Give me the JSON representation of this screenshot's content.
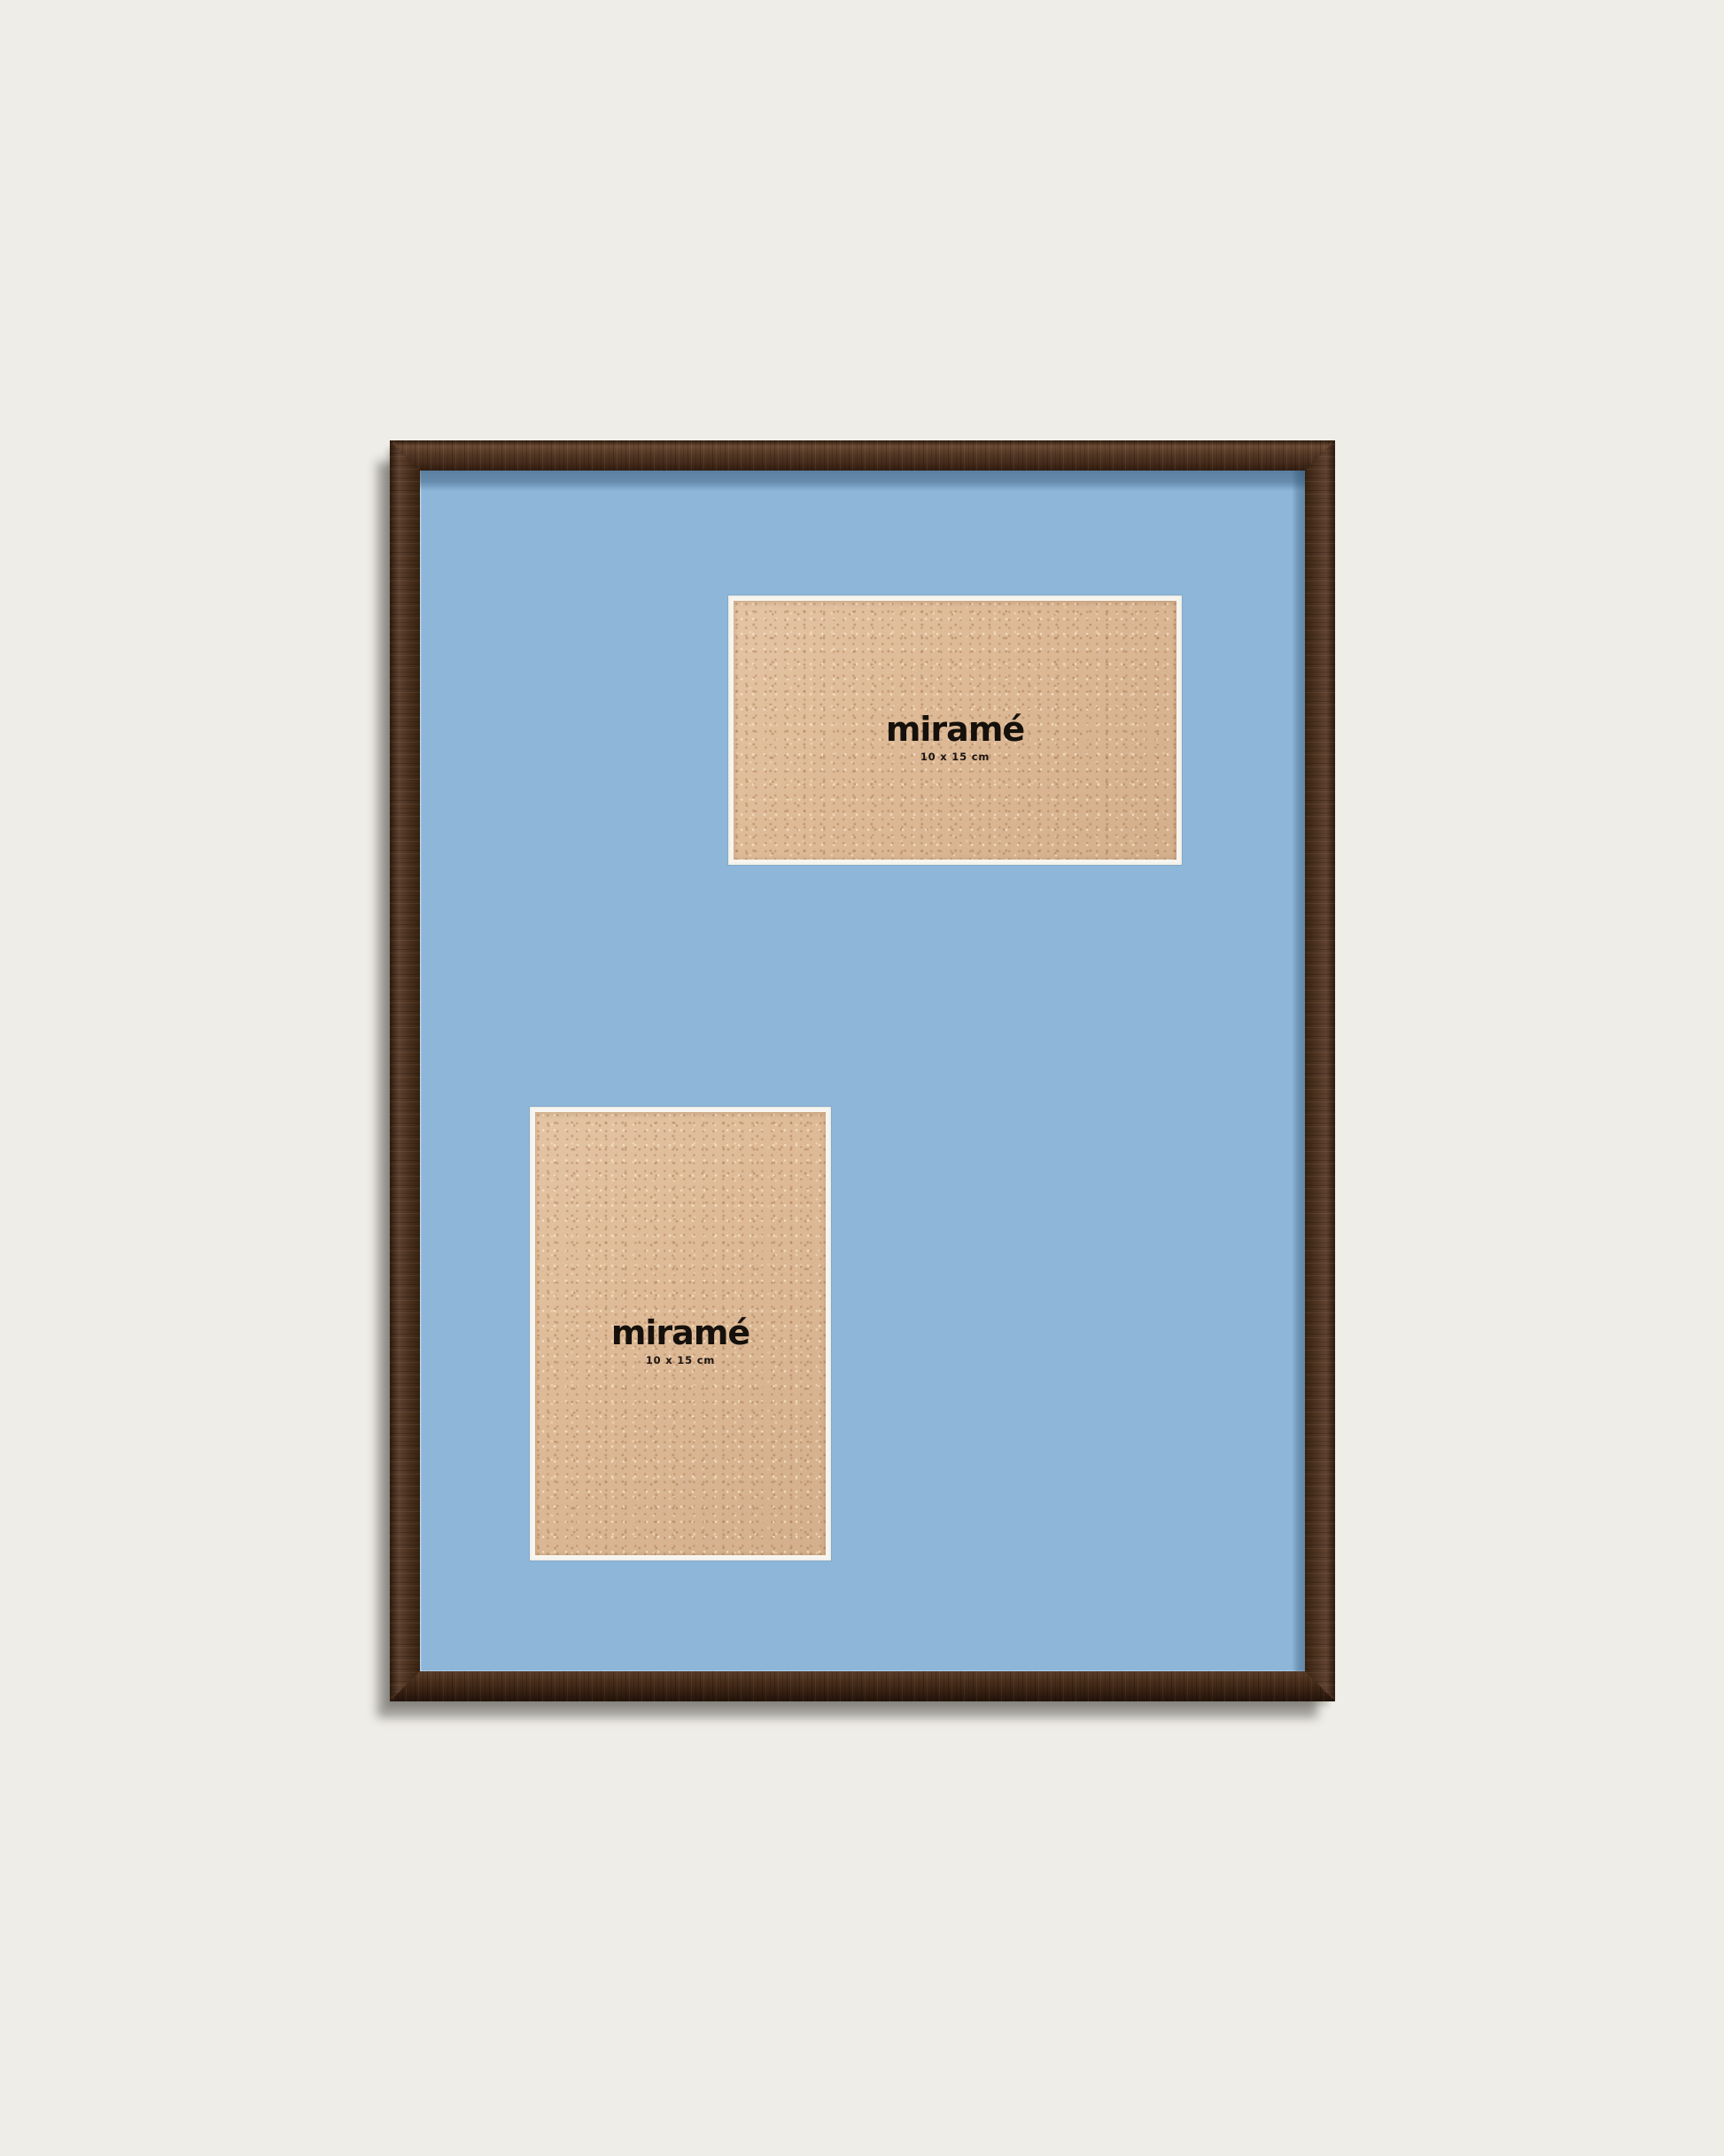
{
  "product": {
    "type_label": "picture-frame-product-photo",
    "frame_color_hex": "#4c3220",
    "mat_color_hex": "#8db6d9",
    "bevel_color_hex": "#f7f5ef",
    "board_color_hex": "#deba97",
    "background_color_hex": "#efede7",
    "plates": [
      {
        "orientation": "landscape",
        "brand": "miramé",
        "size_label": "10 x 15 cm"
      },
      {
        "orientation": "portrait",
        "brand": "miramé",
        "size_label": "10 x 15 cm"
      }
    ]
  }
}
